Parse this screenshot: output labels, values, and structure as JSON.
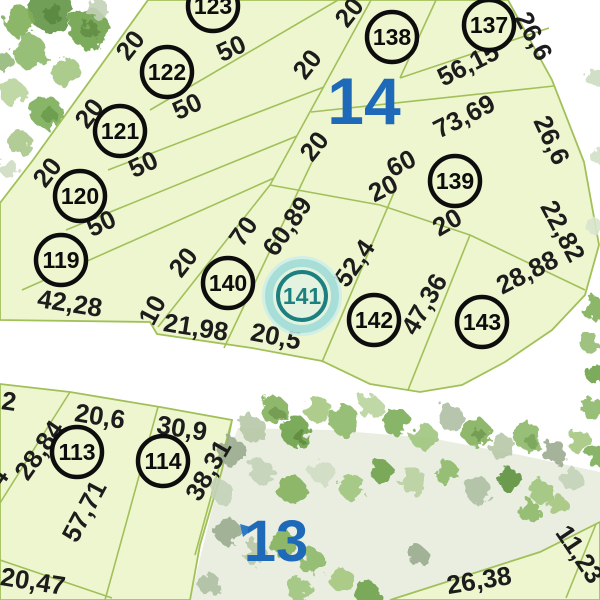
{
  "section_labels": [
    {
      "text": "14",
      "x": 364,
      "y": 100,
      "size": 66
    },
    {
      "text": "13",
      "x": 276,
      "y": 540,
      "size": 58
    }
  ],
  "plots": [
    {
      "number": "123",
      "x": 213,
      "y": 6,
      "highlighted": false
    },
    {
      "number": "122",
      "x": 167,
      "y": 72,
      "highlighted": false
    },
    {
      "number": "121",
      "x": 120,
      "y": 131,
      "highlighted": false
    },
    {
      "number": "120",
      "x": 80,
      "y": 196,
      "highlighted": false
    },
    {
      "number": "119",
      "x": 61,
      "y": 260,
      "highlighted": false
    },
    {
      "number": "138",
      "x": 392,
      "y": 37,
      "highlighted": false
    },
    {
      "number": "137",
      "x": 489,
      "y": 25,
      "highlighted": false
    },
    {
      "number": "139",
      "x": 455,
      "y": 181,
      "highlighted": false
    },
    {
      "number": "140",
      "x": 228,
      "y": 283,
      "highlighted": false
    },
    {
      "number": "141",
      "x": 302,
      "y": 296,
      "highlighted": true
    },
    {
      "number": "142",
      "x": 374,
      "y": 320,
      "highlighted": false
    },
    {
      "number": "143",
      "x": 482,
      "y": 322,
      "highlighted": false
    },
    {
      "number": "113",
      "x": 77,
      "y": 452,
      "highlighted": false
    },
    {
      "number": "114",
      "x": 163,
      "y": 461,
      "highlighted": false
    }
  ],
  "dimension_labels": [
    {
      "text": "50",
      "x": 231,
      "y": 48,
      "rot": -25
    },
    {
      "text": "50",
      "x": 187,
      "y": 106,
      "rot": -25
    },
    {
      "text": "50",
      "x": 143,
      "y": 164,
      "rot": -25
    },
    {
      "text": "50",
      "x": 101,
      "y": 223,
      "rot": -25
    },
    {
      "text": "20",
      "x": 130,
      "y": 45,
      "rot": -52
    },
    {
      "text": "20",
      "x": 89,
      "y": 113,
      "rot": -52
    },
    {
      "text": "20",
      "x": 47,
      "y": 172,
      "rot": -52
    },
    {
      "text": "20",
      "x": 349,
      "y": 12,
      "rot": -52
    },
    {
      "text": "20",
      "x": 307,
      "y": 64,
      "rot": -52
    },
    {
      "text": "20",
      "x": 314,
      "y": 146,
      "rot": -52
    },
    {
      "text": "56,15",
      "x": 468,
      "y": 64,
      "rot": -27
    },
    {
      "text": "73,69",
      "x": 464,
      "y": 116,
      "rot": -27
    },
    {
      "text": "26,6",
      "x": 534,
      "y": 36,
      "rot": 62
    },
    {
      "text": "26,6",
      "x": 552,
      "y": 140,
      "rot": 65
    },
    {
      "text": "22,82",
      "x": 563,
      "y": 231,
      "rot": 62
    },
    {
      "text": "28,88",
      "x": 527,
      "y": 272,
      "rot": -27
    },
    {
      "text": "60",
      "x": 401,
      "y": 163,
      "rot": -27
    },
    {
      "text": "20",
      "x": 383,
      "y": 188,
      "rot": -27
    },
    {
      "text": "20",
      "x": 447,
      "y": 222,
      "rot": -30
    },
    {
      "text": "70",
      "x": 243,
      "y": 231,
      "rot": -55
    },
    {
      "text": "60,89",
      "x": 287,
      "y": 226,
      "rot": -55
    },
    {
      "text": "52,4",
      "x": 354,
      "y": 263,
      "rot": -55
    },
    {
      "text": "47,36",
      "x": 424,
      "y": 304,
      "rot": -60
    },
    {
      "text": "20",
      "x": 183,
      "y": 262,
      "rot": -52
    },
    {
      "text": "10",
      "x": 152,
      "y": 310,
      "rot": -62
    },
    {
      "text": "42,28",
      "x": 70,
      "y": 303,
      "rot": 9
    },
    {
      "text": "21,98",
      "x": 196,
      "y": 327,
      "rot": 9
    },
    {
      "text": "20,5",
      "x": 276,
      "y": 336,
      "rot": 11
    },
    {
      "text": "2",
      "x": 9,
      "y": 401,
      "rot": 8
    },
    {
      "text": "28,84",
      "x": 39,
      "y": 450,
      "rot": -55
    },
    {
      "text": "20,6",
      "x": 100,
      "y": 416,
      "rot": 9
    },
    {
      "text": "30,9",
      "x": 182,
      "y": 428,
      "rot": 9
    },
    {
      "text": "57,71",
      "x": 84,
      "y": 511,
      "rot": -62
    },
    {
      "text": "38,31",
      "x": 208,
      "y": 470,
      "rot": -60
    },
    {
      "text": "20,47",
      "x": 33,
      "y": 581,
      "rot": 9
    },
    {
      "text": "84",
      "x": -6,
      "y": 483,
      "rot": -55
    },
    {
      "text": "26,38",
      "x": 479,
      "y": 580,
      "rot": -9
    },
    {
      "text": "11,23",
      "x": 580,
      "y": 554,
      "rot": 56
    }
  ],
  "colors": {
    "background": "#ffffff",
    "parcel_fill": "#edf6cf",
    "parcel_line": "#a2c05a",
    "label_text": "#1c1c1c",
    "plot_ring": "#0d0d0d",
    "section_number_blue": "#1e6ab8",
    "highlight_teal": "#1d8080",
    "highlight_ring_light": "#a8ded8",
    "woods_fill": "#e9eee1",
    "marker_blue": "#2e78c8"
  }
}
